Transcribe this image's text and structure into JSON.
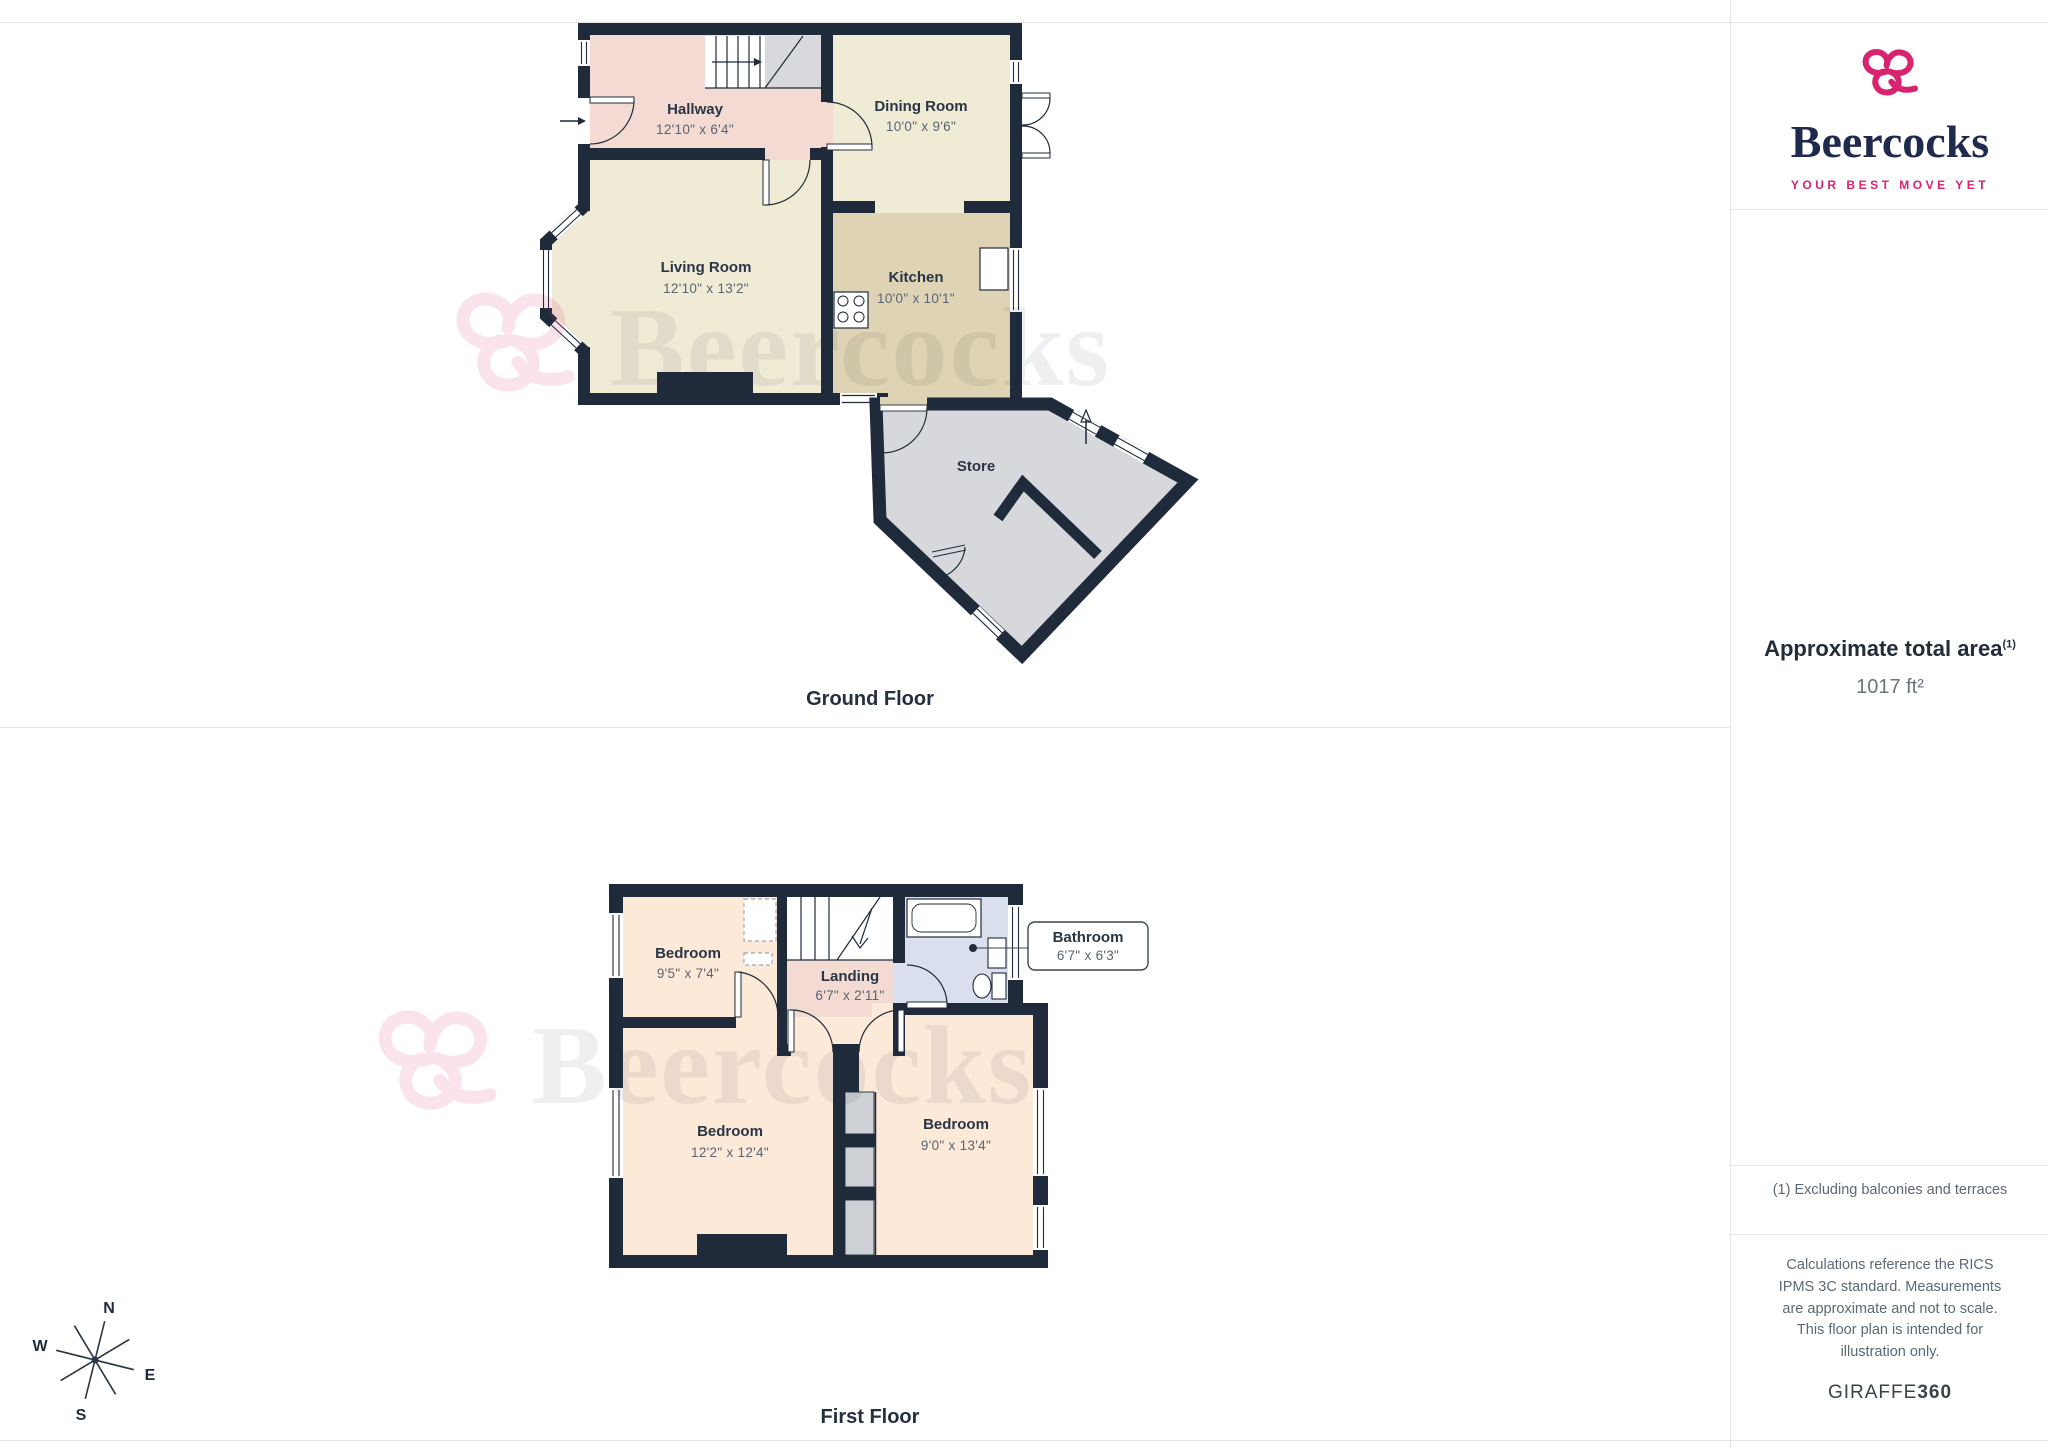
{
  "brand": {
    "name": "Beercocks",
    "tagline": "YOUR BEST MOVE YET"
  },
  "sidebar": {
    "area_title": "Approximate total area",
    "area_note_ref": "(1)",
    "area_value": "1017 ft²",
    "footnote": "(1) Excluding balconies and terraces",
    "disclaimer": "Calculations reference the RICS IPMS 3C standard. Measurements are approximate and not to scale. This floor plan is intended for illustration only.",
    "credit_name": "GIRAFFE",
    "credit_num": "360"
  },
  "ground_floor": {
    "caption": "Ground Floor",
    "hallway_name": "Hallway",
    "hallway_dims": "12'10\" x 6'4\"",
    "dining_name": "Dining Room",
    "dining_dims": "10'0\" x 9'6\"",
    "living_name": "Living Room",
    "living_dims": "12'10\" x 13'2\"",
    "kitchen_name": "Kitchen",
    "kitchen_dims": "10'0\" x 10'1\"",
    "store_name": "Store"
  },
  "first_floor": {
    "caption": "First Floor",
    "bedroom1_name": "Bedroom",
    "bedroom1_dims": "9'5\" x 7'4\"",
    "landing_name": "Landing",
    "landing_dims": "6'7\" x 2'11\"",
    "bathroom_name": "Bathroom",
    "bathroom_dims": "6'7\" x 6'3\"",
    "bedroom2_name": "Bedroom",
    "bedroom2_dims": "12'2\" x 12'4\"",
    "bedroom3_name": "Bedroom",
    "bedroom3_dims": "9'0\" x 13'4\""
  },
  "compass": {
    "north": "N",
    "east": "E",
    "south": "S",
    "west": "W"
  },
  "watermark": {
    "text": "Beercocks"
  },
  "palette": {
    "brand_pink": "#d8236f",
    "brand_navy": "#1f2a4d",
    "wall": "#1f2b3b",
    "hallway_landing": "#f3dad2",
    "living_dining": "#f0ebd5",
    "kitchen": "#ded3b4",
    "store": "#d6d8db",
    "bedroom": "#fce9d8",
    "bathroom": "#d9dfec",
    "cupboard": "#cdd0d4"
  }
}
